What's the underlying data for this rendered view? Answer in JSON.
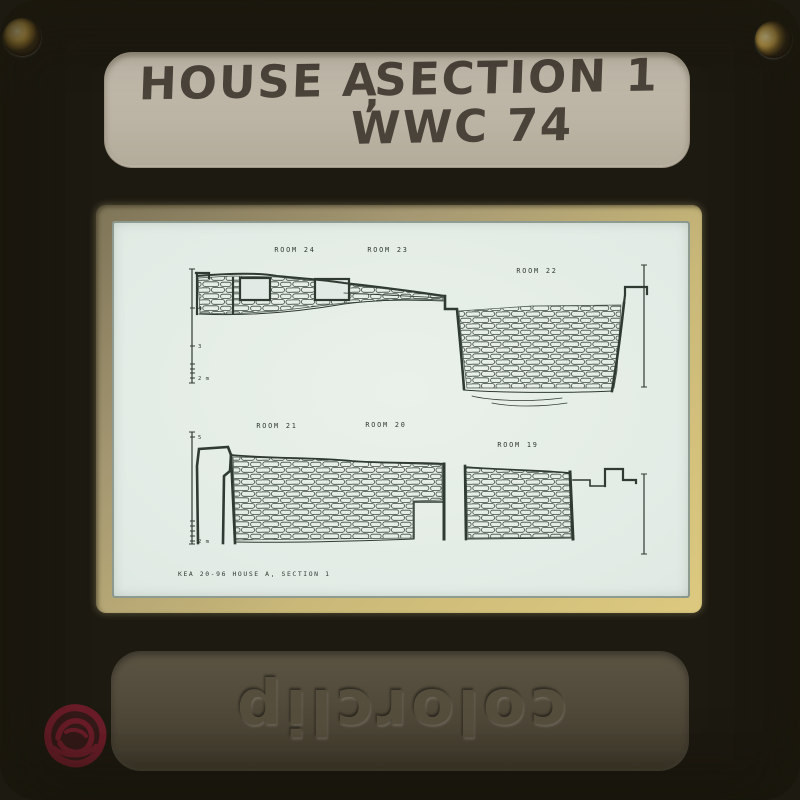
{
  "slide_mount": {
    "label": {
      "line1_part1": "HOUSE A",
      "line1_mark": ",",
      "line1_part2": "SECTION 1",
      "line2": "WWC 74"
    },
    "brand": "colorclip",
    "colors": {
      "mount": "#ab9f80",
      "mount_dark": "#443e2d",
      "label_panel": "#bcb4a4",
      "aperture_glow": "#ddc97f",
      "handwriting": "#4a433a",
      "red_mark": "#7c1e2e"
    }
  },
  "film": {
    "background": "#e1eae4",
    "ink": "#2e3a32",
    "caption": {
      "text": "KEA 20-96   HOUSE A, SECTION 1",
      "x": 66,
      "y": 355
    },
    "room_labels": [
      {
        "label": "ROOM 24",
        "x": 183,
        "y": 31
      },
      {
        "label": "ROOM 23",
        "x": 276,
        "y": 31
      },
      {
        "label": "ROOM 22",
        "x": 425,
        "y": 52
      },
      {
        "label": "ROOM 21",
        "x": 165,
        "y": 207
      },
      {
        "label": "ROOM 20",
        "x": 274,
        "y": 206
      },
      {
        "label": "ROOM 19",
        "x": 406,
        "y": 226
      }
    ],
    "scalebars": [
      {
        "x": 80,
        "y1": 48,
        "y2": 162,
        "ticks": [
          {
            "y": 87,
            "t": "4"
          },
          {
            "y": 125,
            "t": "3"
          },
          {
            "y": 143,
            "t": ""
          },
          {
            "y": 148,
            "t": ""
          },
          {
            "y": 152,
            "t": ""
          },
          {
            "y": 157,
            "t": "2 m"
          }
        ]
      },
      {
        "x": 532,
        "y1": 44,
        "y2": 166,
        "ticks": []
      },
      {
        "x": 80,
        "y1": 211,
        "y2": 323,
        "ticks": [
          {
            "y": 216,
            "t": "5"
          },
          {
            "y": 300,
            "t": ""
          },
          {
            "y": 305,
            "t": ""
          },
          {
            "y": 310,
            "t": ""
          },
          {
            "y": 315,
            "t": ""
          },
          {
            "y": 320,
            "t": "2 m"
          }
        ]
      },
      {
        "x": 532,
        "y1": 253,
        "y2": 333,
        "ticks": []
      }
    ],
    "masonry_regions": [
      {
        "d": "M86,57 L120,55 L165,56 L232,63 L300,71 L331,76 L331,79 L300,78 L232,82 L165,90 L120,93 L88,92 Z"
      },
      {
        "d": "M347,90 L420,85 L509,84 L505,150 L502,167 L355,167 L350,125 Z"
      },
      {
        "d": "M121,236 L200,238 L280,242 L330,244 L330,279 L301,280 L301,317 L124,319 Z"
      },
      {
        "d": "M354,247 L458,252 L459,316 L356,317 Z"
      }
    ],
    "openings": [
      {
        "x": 128,
        "y": 57,
        "w": 30,
        "h": 22
      },
      {
        "x": 203,
        "y": 58,
        "w": 34,
        "h": 21
      }
    ],
    "outlines": [
      {
        "d": "M84,52 L97,52 L97,57",
        "w": 2.2
      },
      {
        "d": "M85,52 L85,93",
        "w": 2.2
      },
      {
        "d": "M85,55 C120,52 150,52 165,55 C200,58 220,60 232,62 C270,66 300,70 333,75",
        "w": 2
      },
      {
        "d": "M87,93 C130,95 180,92 232,83 C270,78 300,79 333,80",
        "w": 0.9
      },
      {
        "d": "M121,57 L121,92",
        "w": 2.2
      },
      {
        "d": "M232,72 L333,77",
        "w": 0.8
      },
      {
        "d": "M333,75 L333,88 L345,88 C347,110 350,140 352,168",
        "w": 2.6
      },
      {
        "d": "M352,169 C390,172 460,172 500,170",
        "w": 1
      },
      {
        "d": "M500,170 C505,140 509,110 512,82",
        "w": 2.6
      },
      {
        "d": "M512,82 L513,74 L513,66 L535,66 L535,73",
        "w": 2.2
      },
      {
        "d": "M360,175 C380,180 420,181 450,177",
        "w": 0.7
      },
      {
        "d": "M380,182 C400,186 430,186 455,182",
        "w": 0.7
      },
      {
        "d": "M86,322 L85,245 L87,228 L116,226 L119,234 L118,250 L112,255 L111,322",
        "w": 2.6
      },
      {
        "d": "M119,234 L123,322",
        "w": 2.6
      },
      {
        "d": "M119,234 C160,238 200,236 240,240 C280,243 310,241 332,243",
        "w": 1.8
      },
      {
        "d": "M332,243 L332,318",
        "w": 3
      },
      {
        "d": "M302,281 L330,281 M302,281 L302,317",
        "w": 1.4
      },
      {
        "d": "M123,321 C180,322 250,320 302,318",
        "w": 1
      },
      {
        "d": "M355,318 L460,317",
        "w": 1
      },
      {
        "d": "M353,245 L354,318",
        "w": 2.6
      },
      {
        "d": "M353,246 C390,249 430,249 458,252",
        "w": 1.6
      },
      {
        "d": "M458,251 L461,318",
        "w": 3
      },
      {
        "d": "M461,259 L478,259 L478,265 L493,265",
        "w": 1.6
      },
      {
        "d": "M493,265 L493,248 L511,248 L511,259 L524,259 L524,262",
        "w": 2.2
      }
    ]
  }
}
